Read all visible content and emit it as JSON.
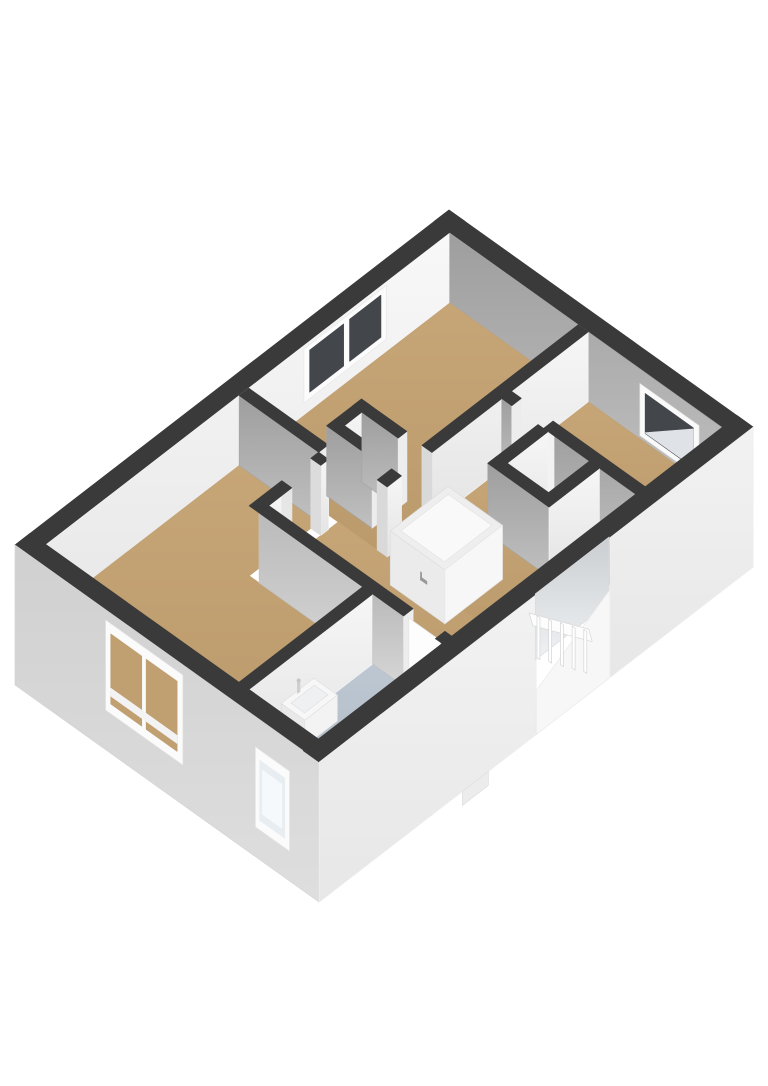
{
  "scene": {
    "title": "3D floor plan",
    "type": "isometric-3d-floorplan",
    "background": "#ffffff",
    "palette": {
      "wall_cut": "#3a3a3a",
      "wall_face_light": "#f4f4f4",
      "wall_face_shadow": "#a6a6a6",
      "wall_face_shadow_light": "#c0c0c0",
      "exterior_left": "#d4d4d4",
      "exterior_front": "#efefef",
      "floor_wood": "#c2a173",
      "floor_bathroom": "#b7c1cc",
      "floor_light": "#e6e6e6",
      "stairwell_gray": "#d9dcdf",
      "glass_dark": "#43474c",
      "glass_frosted": "#e8edf1",
      "fixture_white": "#f7f7f7",
      "jamb_white": "#ededed"
    },
    "rooms": [
      {
        "name": "bedroom-left",
        "floor": "wood"
      },
      {
        "name": "bedroom-back",
        "floor": "wood",
        "windows": 1
      },
      {
        "name": "bedroom-right",
        "floor": "wood",
        "windows": 1
      },
      {
        "name": "landing-hall",
        "floor": "wood",
        "features": [
          "staircase-enclosure",
          "stair-opening",
          "stair-railing",
          "shaft-nook"
        ]
      },
      {
        "name": "bathroom",
        "floor": "bathroom",
        "windows": 1,
        "fixtures": [
          "washbasin",
          "toilet",
          "door"
        ]
      },
      {
        "name": "closet",
        "floor": "light"
      }
    ],
    "facade_front_windows": 2,
    "railing_balusters": 5,
    "stair_steps_visible": 6
  }
}
